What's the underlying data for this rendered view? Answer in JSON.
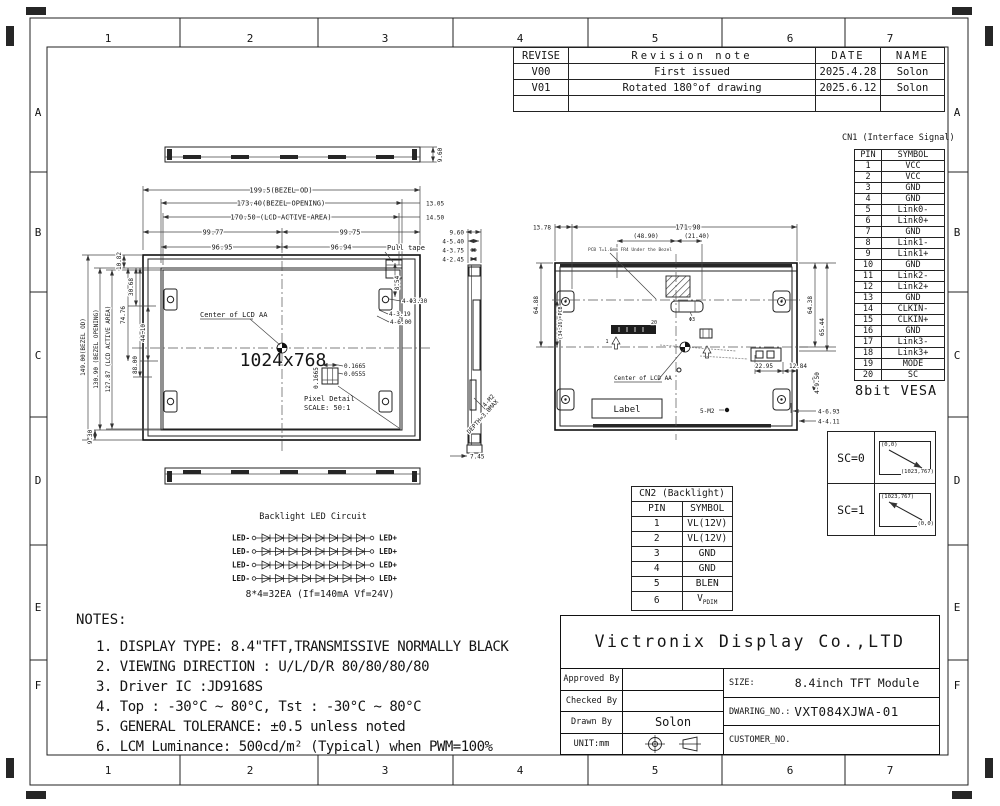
{
  "frame": {
    "cols": [
      "1",
      "2",
      "3",
      "4",
      "5",
      "6",
      "7"
    ],
    "rows": [
      "A",
      "B",
      "C",
      "D",
      "E",
      "F"
    ]
  },
  "revision_table": {
    "headers": [
      "REVISE",
      "Revision note",
      "DATE",
      "NAME"
    ],
    "rows": [
      {
        "rev": "V00",
        "note": "First issued",
        "date": "2025.4.28",
        "name": "Solon"
      },
      {
        "rev": "V01",
        "note": "Rotated 180°of drawing",
        "date": "2025.6.12",
        "name": "Solon"
      }
    ]
  },
  "cn1": {
    "title": "CN1 (Interface Signal)",
    "pin_header": "PIN",
    "symbol_header": "SYMBOL",
    "rows": [
      {
        "pin": "1",
        "symbol": "VCC"
      },
      {
        "pin": "2",
        "symbol": "VCC"
      },
      {
        "pin": "3",
        "symbol": "GND"
      },
      {
        "pin": "4",
        "symbol": "GND"
      },
      {
        "pin": "5",
        "symbol": "Link0-"
      },
      {
        "pin": "6",
        "symbol": "Link0+"
      },
      {
        "pin": "7",
        "symbol": "GND"
      },
      {
        "pin": "8",
        "symbol": "Link1-"
      },
      {
        "pin": "9",
        "symbol": "Link1+"
      },
      {
        "pin": "10",
        "symbol": "GND"
      },
      {
        "pin": "11",
        "symbol": "Link2-"
      },
      {
        "pin": "12",
        "symbol": "Link2+"
      },
      {
        "pin": "13",
        "symbol": "GND"
      },
      {
        "pin": "14",
        "symbol": "CLKIN-"
      },
      {
        "pin": "15",
        "symbol": "CLKIN+"
      },
      {
        "pin": "16",
        "symbol": "GND"
      },
      {
        "pin": "17",
        "symbol": "Link3-"
      },
      {
        "pin": "18",
        "symbol": "Link3+"
      },
      {
        "pin": "19",
        "symbol": "MODE"
      },
      {
        "pin": "20",
        "symbol": "SC"
      }
    ],
    "footer": "8bit VESA"
  },
  "cn2": {
    "title": "CN2 (Backlight)",
    "pin_header": "PIN",
    "symbol_header": "SYMBOL",
    "rows": [
      {
        "pin": "1",
        "symbol": "VL(12V)"
      },
      {
        "pin": "2",
        "symbol": "VL(12V)"
      },
      {
        "pin": "3",
        "symbol": "GND"
      },
      {
        "pin": "4",
        "symbol": "GND"
      },
      {
        "pin": "5",
        "symbol": "BLEN"
      },
      {
        "pin": "6",
        "symbol": "V",
        "symbol_sub": "PDIM"
      }
    ]
  },
  "sc": {
    "rows": [
      {
        "label": "SC=0",
        "tl": "(0,0)",
        "br": "(1023,767)"
      },
      {
        "label": "SC=1",
        "tl": "(1023,767)",
        "br": "(0,0)"
      }
    ]
  },
  "led": {
    "title": "Backlight LED Circuit",
    "neg": "LED-",
    "pos": "LED+",
    "formula": "8*4=32EA (If=140mA Vf=24V)"
  },
  "notes": {
    "title": "NOTES:",
    "items": [
      "1. DISPLAY TYPE: 8.4\"TFT,TRANSMISSIVE NORMALLY BLACK",
      "2. VIEWING DIRECTION : U/L/D/R 80/80/80/80",
      "3. Driver IC :JD9168S",
      "4. Top : -30°C ~ 80°C, Tst : -30°C ~ 80°C",
      "5. GENERAL TOLERANCE: ±0.5 unless noted",
      "6. LCM Luminance:  500cd/m² (Typical) when PWM=100%"
    ]
  },
  "title_block": {
    "company": "Victronix Display Co.,LTD",
    "approved_label": "Approved By",
    "checked_label": "Checked By",
    "drawn_label": "Drawn By",
    "drawn_value": "Solon",
    "unit_label": "UNIT:mm",
    "size_label": "SIZE:",
    "size_value": "8.4inch TFT Module",
    "drawing_no_label": "DWARING_NO.:",
    "drawing_no_value": "VXT084XJWA-01",
    "customer_label": "CUSTOMER_NO."
  },
  "views": {
    "front": {
      "top_view_height": "9.60",
      "bezel_od_w": "199.5(BEZEL OD)",
      "bezel_open_w": "173.40(BEZEL OPENING)",
      "active_w": "170.50 (LCD ACTIVE AREA)",
      "half_w_l": "99.77",
      "half_w_r": "99.75",
      "half_open_l": "96.95",
      "half_open_r": "96.94",
      "off_right_1": "13.05",
      "off_right_2": "14.50",
      "bezel_od_h": "149.00(BEZEL OD)",
      "bezel_open_h": "130.90 (BEZEL OPENING)",
      "active_h": "127.87 (LCD ACTIVE AREA)",
      "off_bottom": "9.30",
      "off_top": "10.82",
      "d30": "30.68",
      "d74": "74.76",
      "d44": "44.10",
      "d88": "88.00",
      "center_label": "Center of LCD AA",
      "resolution": "1024x768",
      "pixel_detail": "Pixel Detail",
      "pixel_scale": "SCALE: 50:1",
      "px_w": "0.1665",
      "px_sub": "0.0555",
      "px_h": "0.1665",
      "pull_tape": "Pull tape",
      "d854": "8.54",
      "hole": "4-Φ3.30",
      "d319": "4-3.19",
      "d600": "4-6.00"
    },
    "side": {
      "h": "9.60",
      "s540": "4-5.40",
      "s375": "4-3.75",
      "s245": "4-2.45",
      "screw": "4-M2",
      "depth": "DEPTH=3.0MAX",
      "d745": "7.45"
    },
    "rear": {
      "d1378": "13.78",
      "d17190": "171.90",
      "d4890": "(48.90)",
      "d2140": "(21.40)",
      "pcb_note": "PCB T=1.6mm FR4 Under the Bezel",
      "d6488": "64.88",
      "d3426": "(34.26) PCB",
      "d6438": "64.38",
      "d6544": "65.44",
      "d2295": "22.95",
      "d1284": "12.84",
      "d950": "4-9.50",
      "d693": "4-6.93",
      "d411": "4-4.11",
      "center_label": "Center of LCD AA",
      "label": "Label",
      "screw": "5-M2",
      "hole": "Φ3",
      "pin1": "1",
      "pin20": "20"
    }
  }
}
